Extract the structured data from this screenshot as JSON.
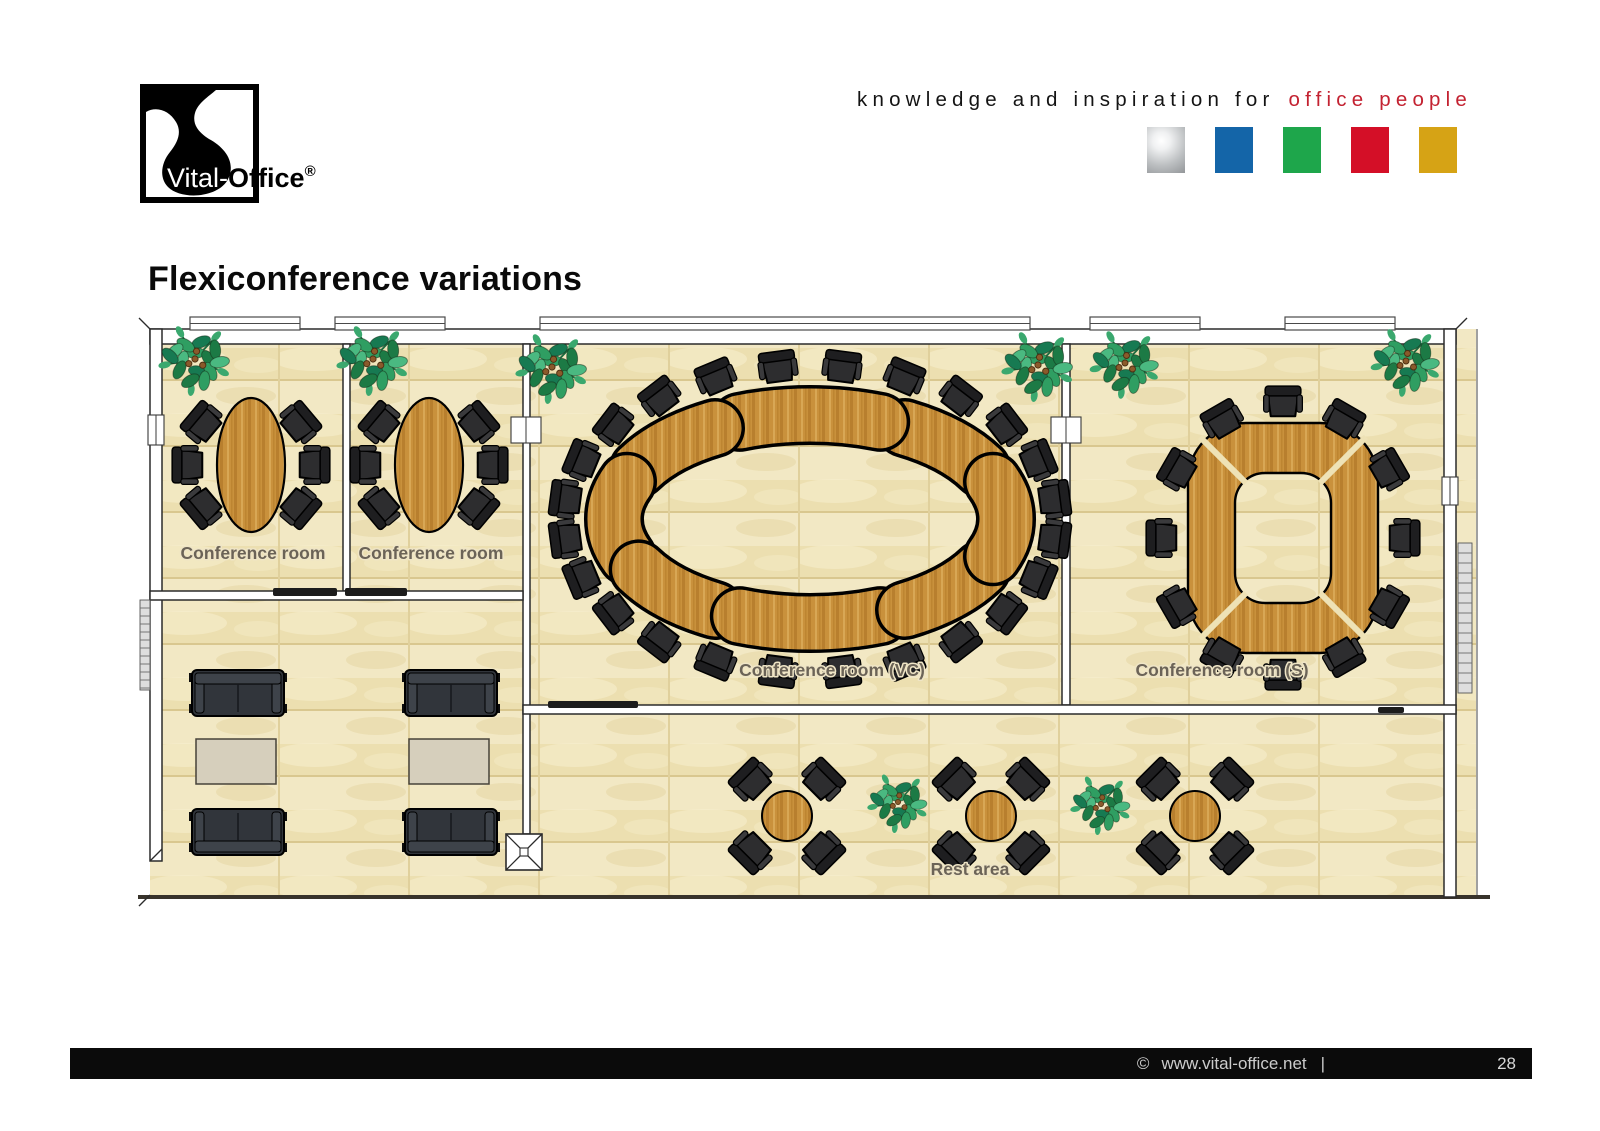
{
  "header": {
    "logo": {
      "brand_light": "Vital-",
      "brand_bold": "Office",
      "registered": "®"
    },
    "tagline_black": "knowledge and inspiration for",
    "tagline_red": "office people",
    "palette_hex": [
      "",
      "#1465a8",
      "#1ea64b",
      "#d40f27",
      "#d6a315"
    ]
  },
  "title": "Flexiconference variations",
  "floorplan": {
    "labels": {
      "room1": "Conference room",
      "room2": "Conference room",
      "vc": "Conference room (VC)",
      "s": "Conference room (S)",
      "rest": "Rest area"
    },
    "rooms": [
      {
        "name": "conference-room-1",
        "label": "Conference room",
        "table": "oval",
        "seats": 6
      },
      {
        "name": "conference-room-2",
        "label": "Conference room",
        "table": "oval",
        "seats": 6
      },
      {
        "name": "conference-room-vc",
        "label": "Conference room (VC)",
        "table": "oval-ring",
        "seats": 24
      },
      {
        "name": "conference-room-s",
        "label": "Conference room (S)",
        "table": "square-ring",
        "seats": 12
      },
      {
        "name": "lounge",
        "sofas": 4,
        "coffee_tables": 2
      },
      {
        "name": "rest-area",
        "label": "Rest area",
        "round_tables": 3,
        "seats_per_table": 4
      }
    ]
  },
  "footer": {
    "copyright_symbol": "©",
    "website": "www.vital-office.net",
    "separator": "|",
    "page_number": "28"
  }
}
